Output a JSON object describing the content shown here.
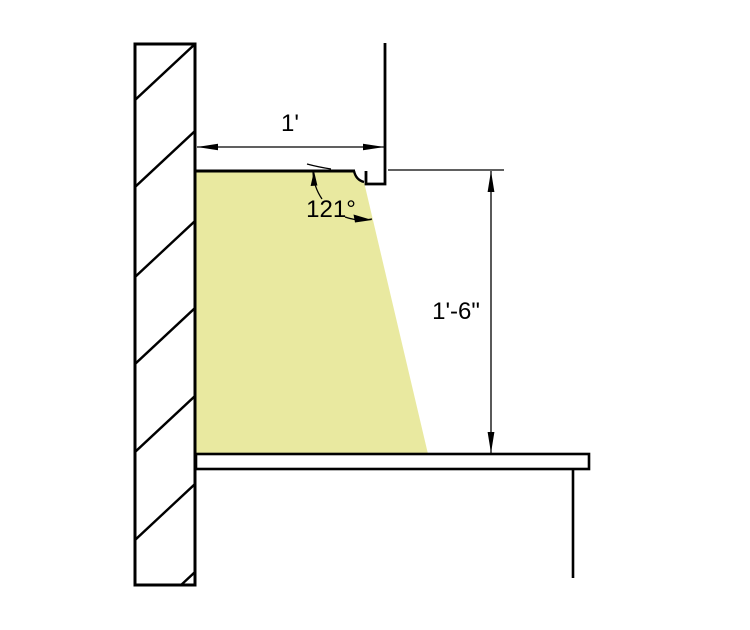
{
  "drawing": {
    "name": "cove-lighting-section-detail",
    "colors": {
      "line": "#000000",
      "beam_fill": "#e9e9a0",
      "background": "#ffffff"
    },
    "annotations": {
      "width_dim": "1'",
      "angle_dim": "121°",
      "height_dim": "1'-6\""
    }
  }
}
